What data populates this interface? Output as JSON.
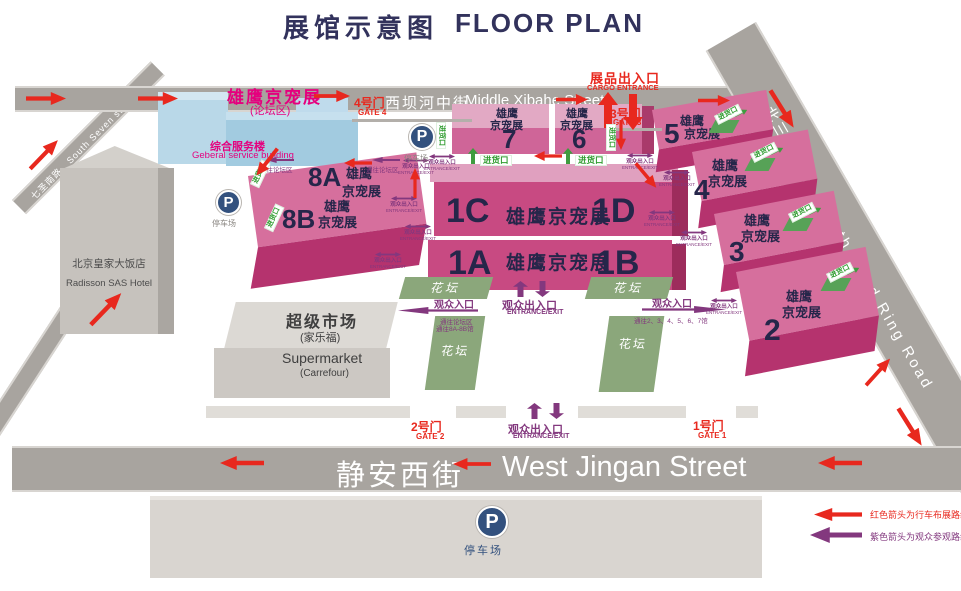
{
  "title": {
    "zh": "展馆示意图",
    "en": "FLOOR PLAN"
  },
  "roads": {
    "xibahe_zh": "西坝河中街",
    "xibahe_en": "Middle Xibahe Street",
    "jingan_zh": "静安西街",
    "jingan_en": "West Jingan Street",
    "ring_zh": "北三环东路",
    "ring_en": "North Third Ring Road",
    "seven_zh": "七圣南路",
    "seven_en": "South Seven st Road"
  },
  "buildings": {
    "hotel_zh": "北京皇家大饭店",
    "hotel_en": "Radisson SAS Hotel",
    "service_zh": "综合服务楼",
    "service_en": "Geberal service building",
    "forum_zh": "雄鹰京宠展",
    "forum_area": "(论坛区)",
    "market_zh": "超级市场",
    "market_zh2": "(家乐福)",
    "market_en": "Supermarket",
    "market_en2": "(Carrefour)"
  },
  "halls": {
    "brand": "雄鹰京宠展",
    "brand_l1": "雄鹰",
    "brand_l2": "京宠展",
    "n1a": "1A",
    "n1b": "1B",
    "n1c": "1C",
    "n1d": "1D",
    "n2": "2",
    "n3": "3",
    "n4": "4",
    "n5": "5",
    "n6": "6",
    "n7": "7",
    "n8a": "8A",
    "n8b": "8B"
  },
  "gates": {
    "g1_zh": "1号门",
    "g1_en": "GATE 1",
    "g2_zh": "2号门",
    "g2_en": "GATE 2",
    "g3_zh": "3号门",
    "g3_en": "GATE 3",
    "g4_zh": "4号门",
    "g4_en": "GATE 4"
  },
  "entrances": {
    "cargo_zh": "展品出入口",
    "cargo_en": "CARGO ENTRANCE",
    "inout_zh": "观众出入口",
    "inout_en": "ENTRANCE/EXIT",
    "in_zh": "观众入口",
    "to_forum": "通往论坛区",
    "to_8ab": "通往8A-8B馆",
    "to_27": "通往2、3、4、5、6、7馆",
    "loading": "进货口"
  },
  "labels": {
    "parking": "停车场",
    "flowerbed": "花坛",
    "p": "P"
  },
  "legend": {
    "red": "红色箭头为行车布展路线",
    "purple": "紫色箭头为观众参观路线"
  },
  "colors": {
    "hall_top": "#D877A4",
    "hall_front": "#BD3A72",
    "road": "#A8A49F",
    "red": "#E8281E",
    "purple": "#83387E",
    "green": "#2F9C2F",
    "magenta": "#E5007E",
    "navy": "#32325C",
    "parking_blue": "#33517E"
  }
}
